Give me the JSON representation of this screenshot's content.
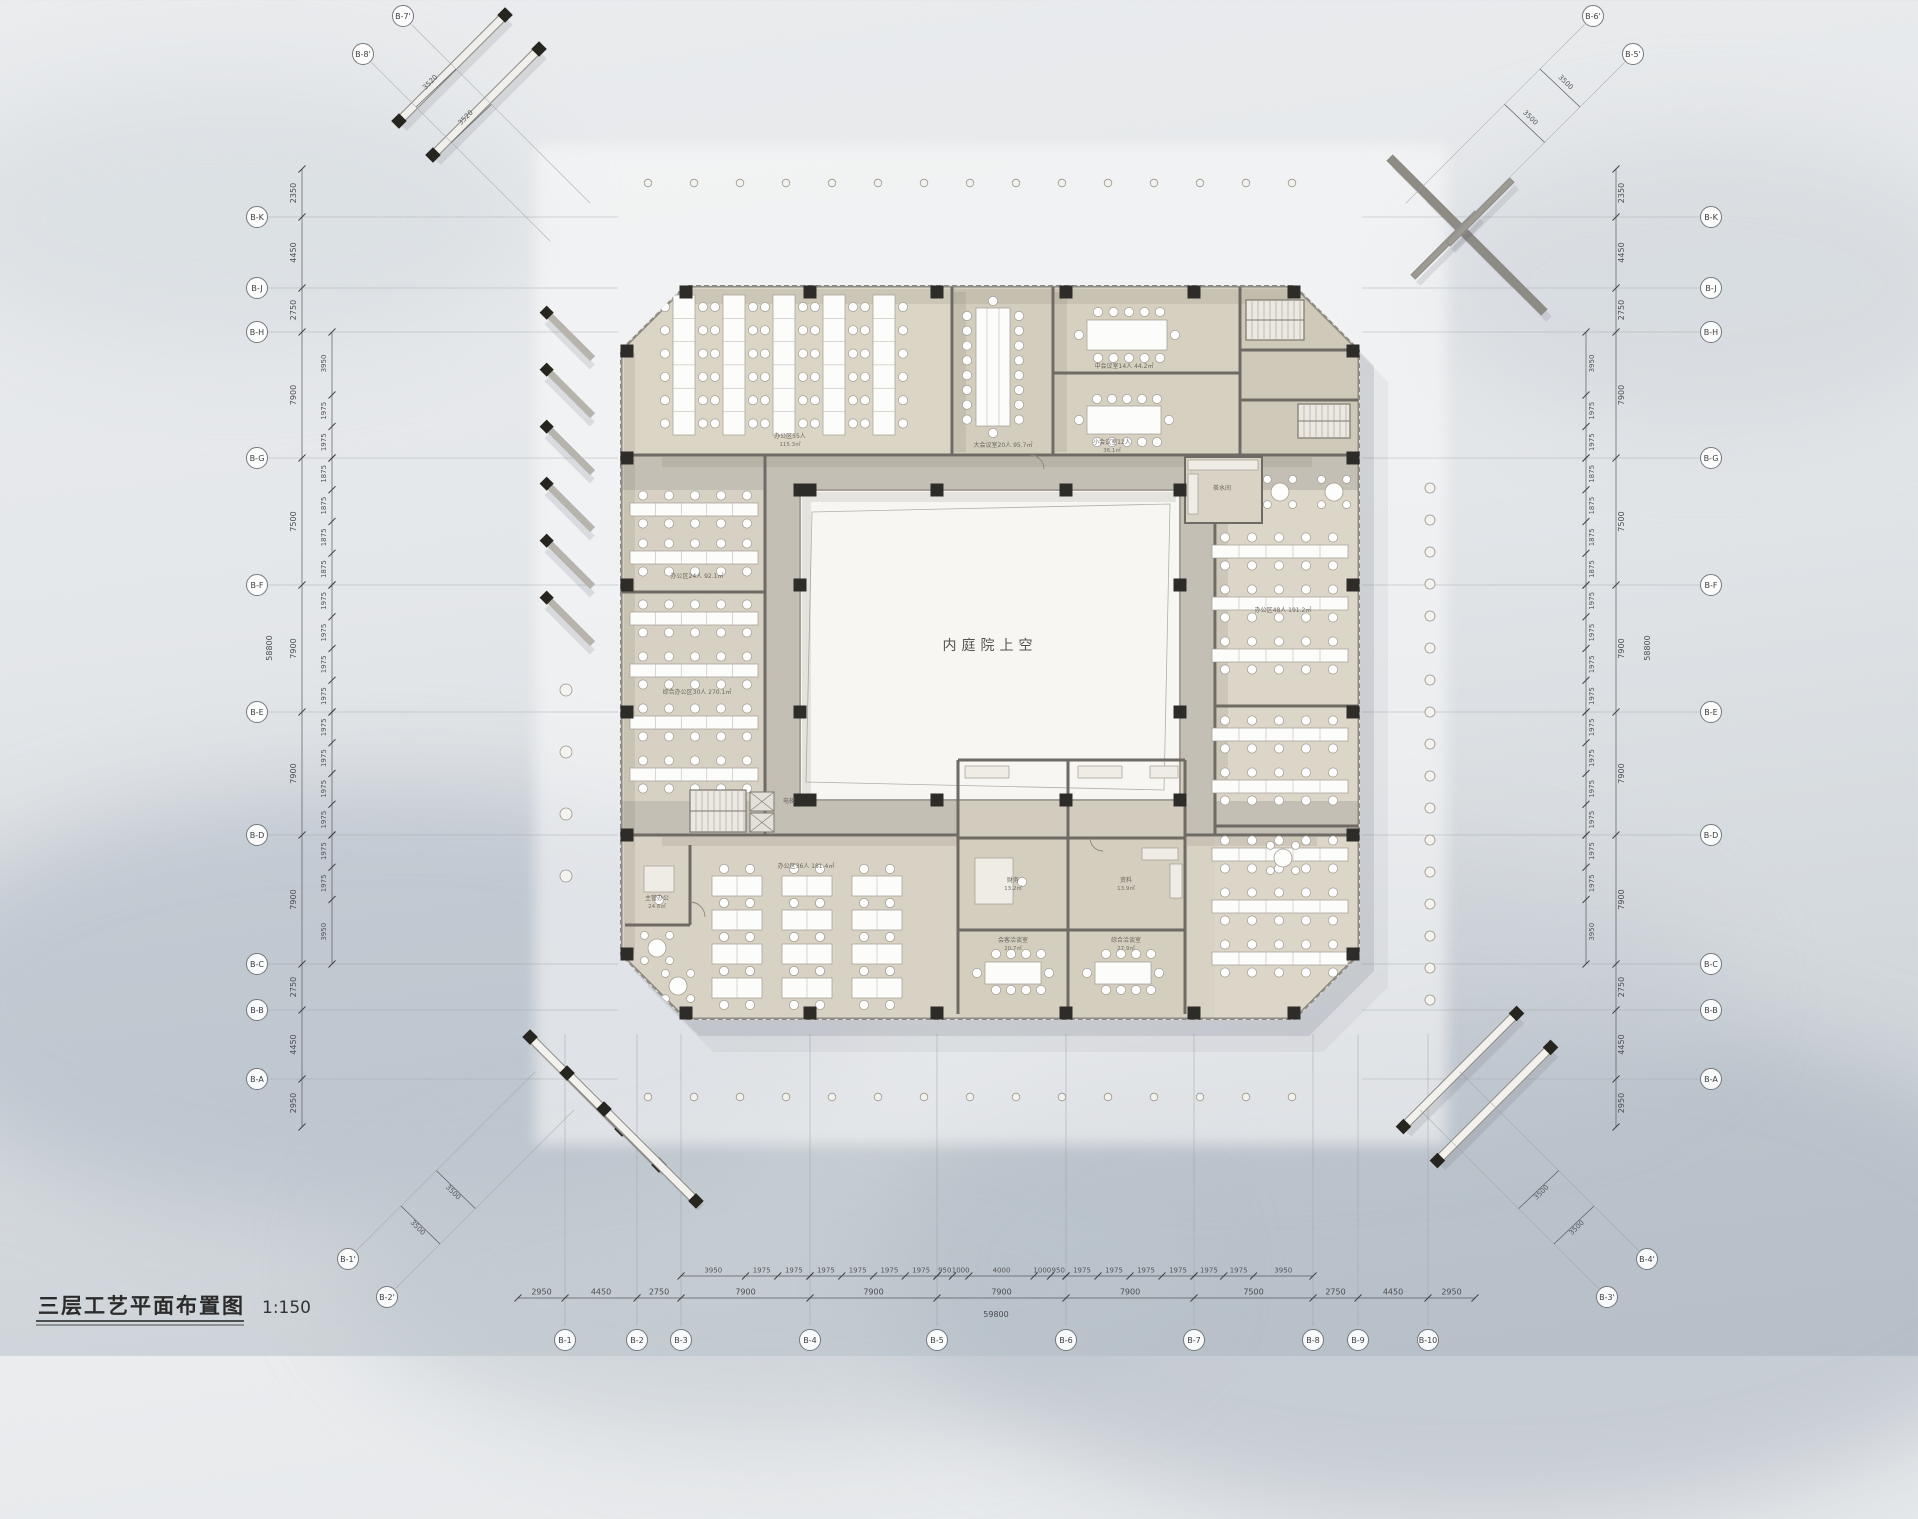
{
  "title": {
    "name": "三层工艺平面布置图",
    "scale": "1:150"
  },
  "courtyard_label": "内庭院上空",
  "axes": {
    "left": [
      "B-K",
      "B-J",
      "B-H",
      "B-G",
      "B-F",
      "B-E",
      "B-D",
      "B-C",
      "B-B",
      "B-A"
    ],
    "right": [
      "B-K",
      "B-J",
      "B-H",
      "B-G",
      "B-F",
      "B-E",
      "B-D",
      "B-C",
      "B-B",
      "B-A"
    ],
    "bottom": [
      "B-1",
      "B-2",
      "B-3",
      "B-4",
      "B-5",
      "B-6",
      "B-7",
      "B-8",
      "B-9",
      "B-10"
    ],
    "corner_top_left": [
      "B-7'",
      "B-8'"
    ],
    "corner_top_right": [
      "B-6'",
      "B-5'"
    ],
    "corner_bottom_left": [
      "B-1'",
      "B-2'"
    ],
    "corner_bottom_right": [
      "B-4'",
      "B-3'"
    ]
  },
  "dimensions": {
    "left_major": [
      "2350",
      "4450",
      "2750",
      "7900",
      "7500",
      "7900",
      "7900",
      "7900",
      "2750",
      "4450",
      "2950"
    ],
    "left_total": "58800",
    "left_minor": [
      "3950",
      "1975",
      "1975",
      "1875",
      "1875",
      "1875",
      "1875",
      "1975",
      "1975",
      "1975",
      "1975",
      "1975",
      "1975",
      "1975",
      "1975",
      "1975",
      "1975",
      "3950"
    ],
    "right_major": [
      "2350",
      "4450",
      "2750",
      "7900",
      "7500",
      "7900",
      "7900",
      "7900",
      "2750",
      "4450",
      "2950"
    ],
    "right_total": "58800",
    "bottom_major": [
      "2950",
      "4450",
      "2750",
      "7900",
      "7900",
      "7900",
      "7900",
      "7500",
      "2750",
      "4450",
      "2950"
    ],
    "bottom_total": "59800",
    "bottom_minor": [
      "3950",
      "1975",
      "1975",
      "1975",
      "1975",
      "1975",
      "1975",
      "950",
      "1000",
      "4000",
      "1000",
      "950",
      "1975",
      "1975",
      "1975",
      "1975",
      "1975",
      "1975",
      "3950"
    ],
    "corner_top_left": [
      "3520",
      "3520"
    ],
    "corner_top_right": [
      "3500",
      "3500"
    ],
    "corner_bottom_left": [
      "3500",
      "3500"
    ],
    "corner_bottom_right": [
      "3500",
      "3500"
    ]
  },
  "rooms": [
    {
      "text": "办公区55人",
      "area": "115.3㎡"
    },
    {
      "text": "大会议室20人 95.7㎡"
    },
    {
      "text": "中会议室14人 44.2㎡"
    },
    {
      "text": "小会议室12人",
      "area": "36.1㎡"
    },
    {
      "text": "办公区24人 92.1㎡"
    },
    {
      "text": "综合办公区30人 270.1㎡"
    },
    {
      "text": "办公区48人 191.2㎡"
    },
    {
      "text": "办公区36人 181.4㎡"
    },
    {
      "text": "财务",
      "area": "13.2㎡"
    },
    {
      "text": "资料",
      "area": "13.9㎡"
    },
    {
      "text": "会客洽谈室",
      "area": "20.7㎡"
    },
    {
      "text": "综合洽谈室",
      "area": "27.9㎡"
    },
    {
      "text": "主管办公",
      "area": "24.6㎡"
    },
    {
      "text": "电梯"
    },
    {
      "text": "茶水间"
    }
  ],
  "colors": {
    "floor": "#d8d2c4",
    "corridor": "#c4bfb4",
    "wall": "#6f6b64",
    "wall_band": "#8f8b84",
    "column": "#2e2c29",
    "courtyard": "#f7f6f2",
    "hatch": "#c8c4bc",
    "dim_text": "#4b4d50",
    "background_top": "#eaecee",
    "background_bottom": "#c7ced4"
  }
}
